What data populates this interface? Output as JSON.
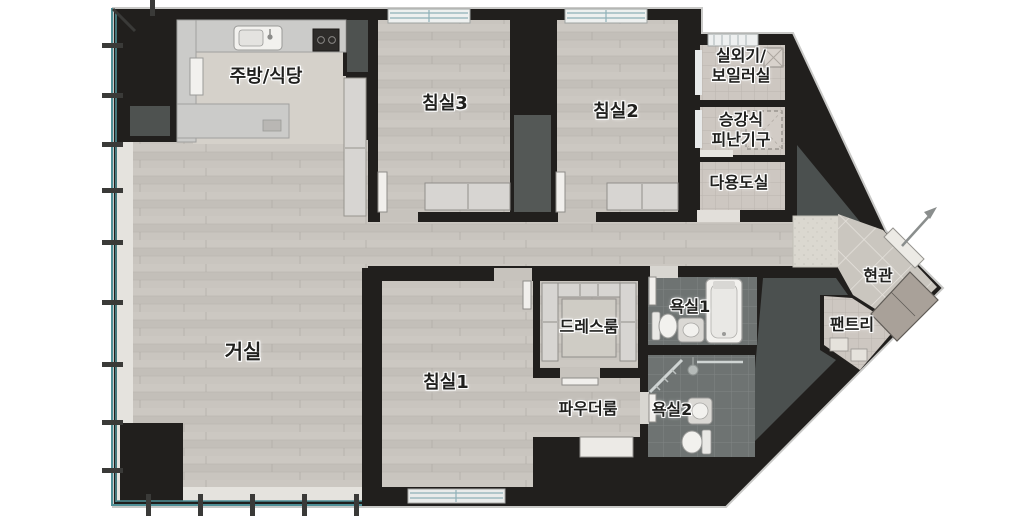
{
  "plan": {
    "type": "korean-apartment-floor-plan",
    "rooms": {
      "kitchen_dining": {
        "label": "주방/식당"
      },
      "bedroom3": {
        "label": "침실3"
      },
      "bedroom2": {
        "label": "침실2"
      },
      "bedroom1": {
        "label": "침실1"
      },
      "living": {
        "label": "거실"
      },
      "outdoor_boiler": {
        "label": "실외기/보일러실",
        "line1": "실외기/",
        "line2": "보일러실"
      },
      "evac_device": {
        "label": "승강식 피난기구",
        "line1": "승강식",
        "line2": "피난기구"
      },
      "utility": {
        "label": "다용도실"
      },
      "entrance": {
        "label": "현관"
      },
      "pantry": {
        "label": "팬트리"
      },
      "bathroom1": {
        "label": "욕실1"
      },
      "bathroom2": {
        "label": "욕실2"
      },
      "dressroom": {
        "label": "드레스룸"
      },
      "powder": {
        "label": "파우더룸"
      }
    },
    "colors": {
      "wall": "#211f1d",
      "wood_floor": "#c8c4be",
      "kitchen_tile": "#d5d1ca",
      "bath_tile": "#6e7372",
      "warm_tile": "#cdc7c1",
      "entry_tile": "#cac6bf",
      "core_fill": "#4b504f",
      "balcony_glass": "#4f9097",
      "closet": "#d7d5d2",
      "fixture_white": "#f2f1ee",
      "shoe_cabinet": "#a9a199"
    },
    "symbols": {
      "entry_arrow": "unit-entry-direction"
    }
  }
}
